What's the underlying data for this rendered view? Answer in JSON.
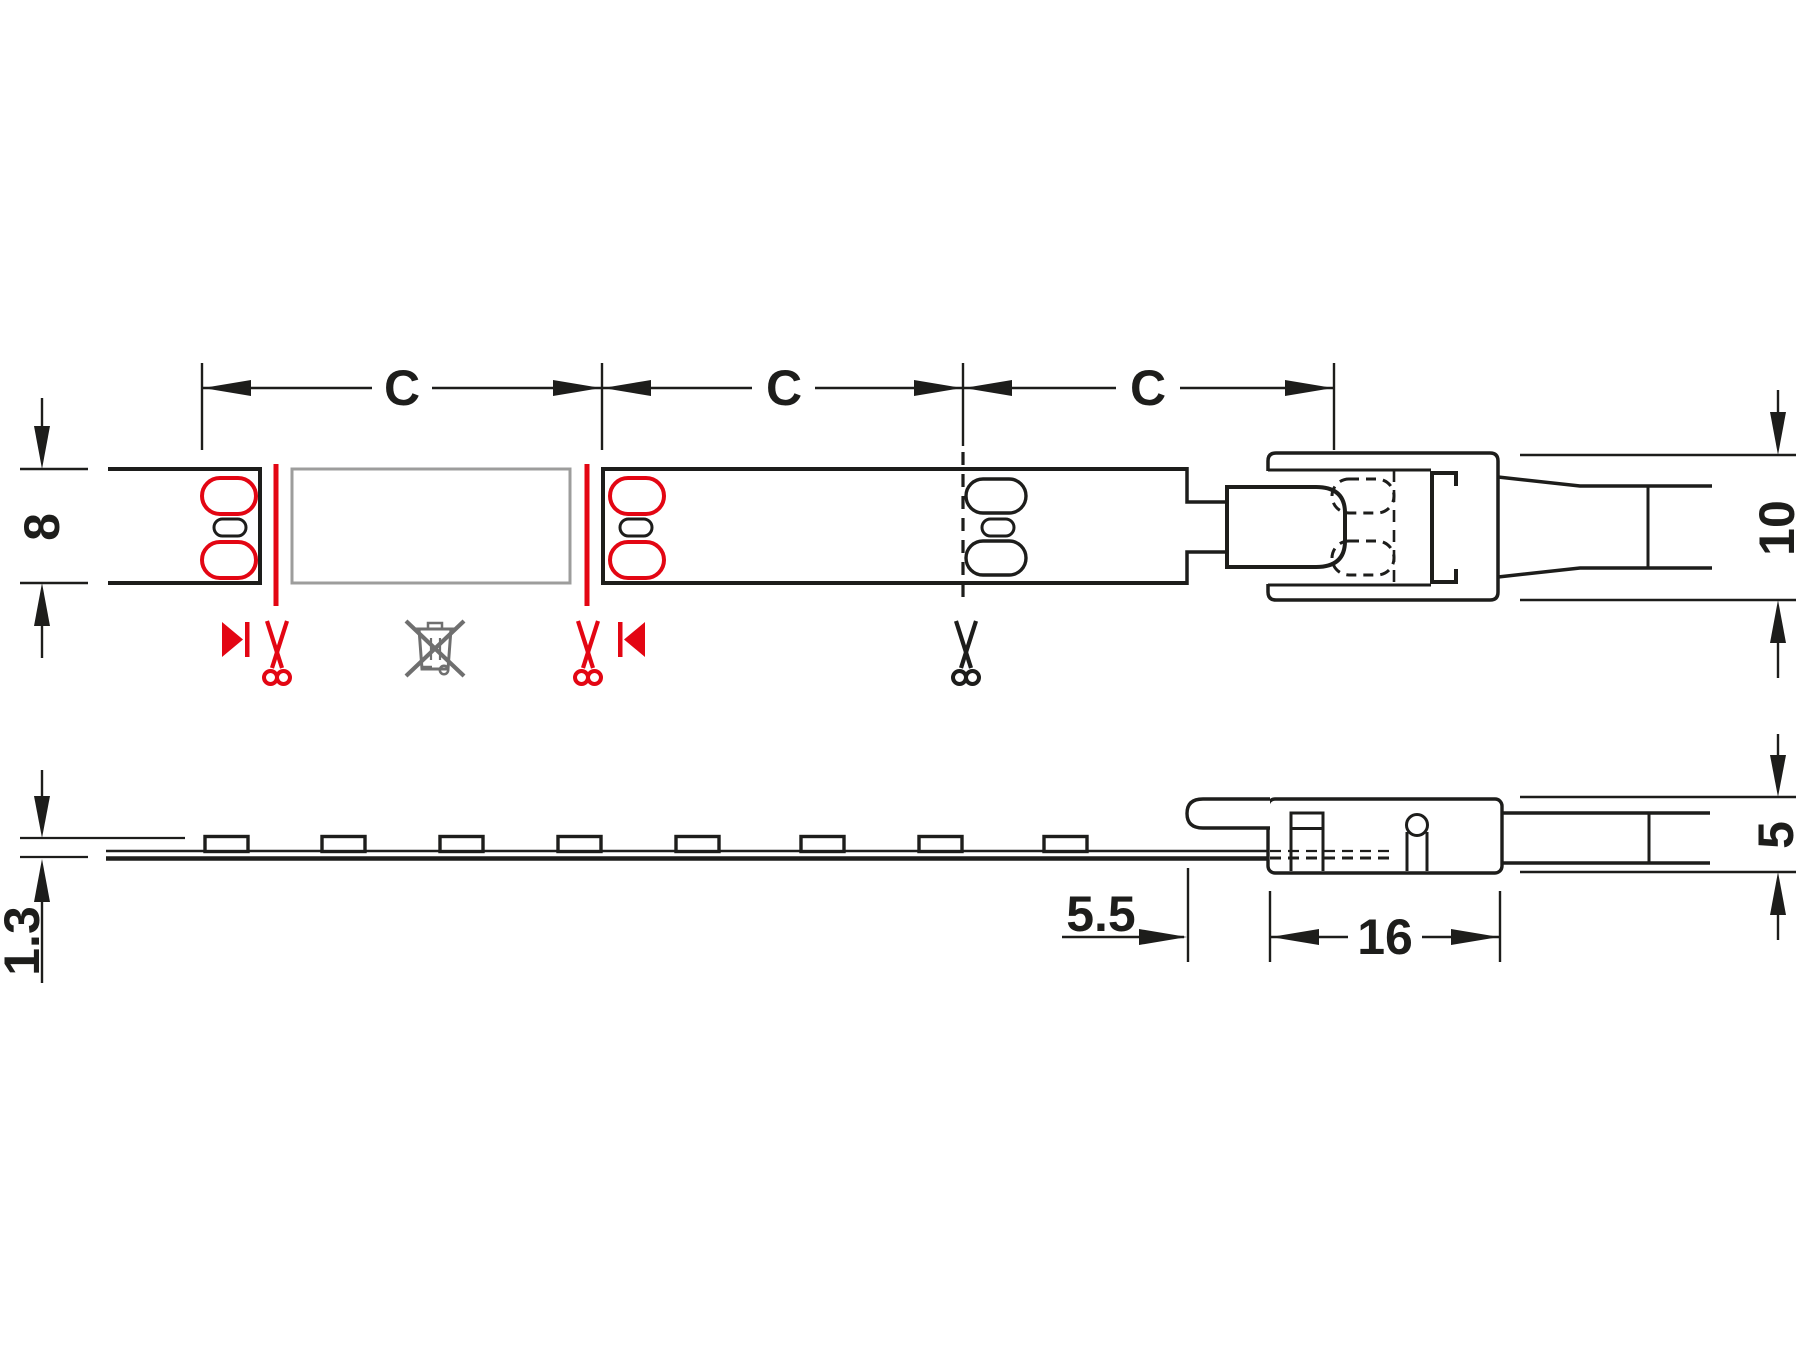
{
  "drawing": {
    "subject": "LED flexible strip light with clip-on cable connector, dimensioned technical drawing",
    "views": [
      "top view",
      "side view"
    ]
  },
  "colors": {
    "red": "#e30613",
    "ink": "#1d1d1b",
    "gray_box": "#9d9d9c",
    "gray_icon": "#6f6f6f",
    "bg": "#ffffff"
  },
  "top_view": {
    "c_labels": [
      "C",
      "C",
      "C"
    ],
    "strip_height_mm": "8",
    "connector_height_mm": "10",
    "cut_points": 3,
    "solder_pad_groups": 4
  },
  "side_view": {
    "strip_thickness_mm": "1.3",
    "clip_tongue_length_mm": "5.5",
    "clip_length_mm": "16",
    "clip_height_mm": "5",
    "led_chip_count": 8
  },
  "icons": {
    "scissors_red": "cut-here scissors (permitted cut point)",
    "scissors_black": "cut-here scissors (mid pad cut point)",
    "direction_start": "play-bar marker",
    "direction_end": "bar-play marker",
    "no_waste_bin": "crossed-out waste bin (do not discard)"
  }
}
